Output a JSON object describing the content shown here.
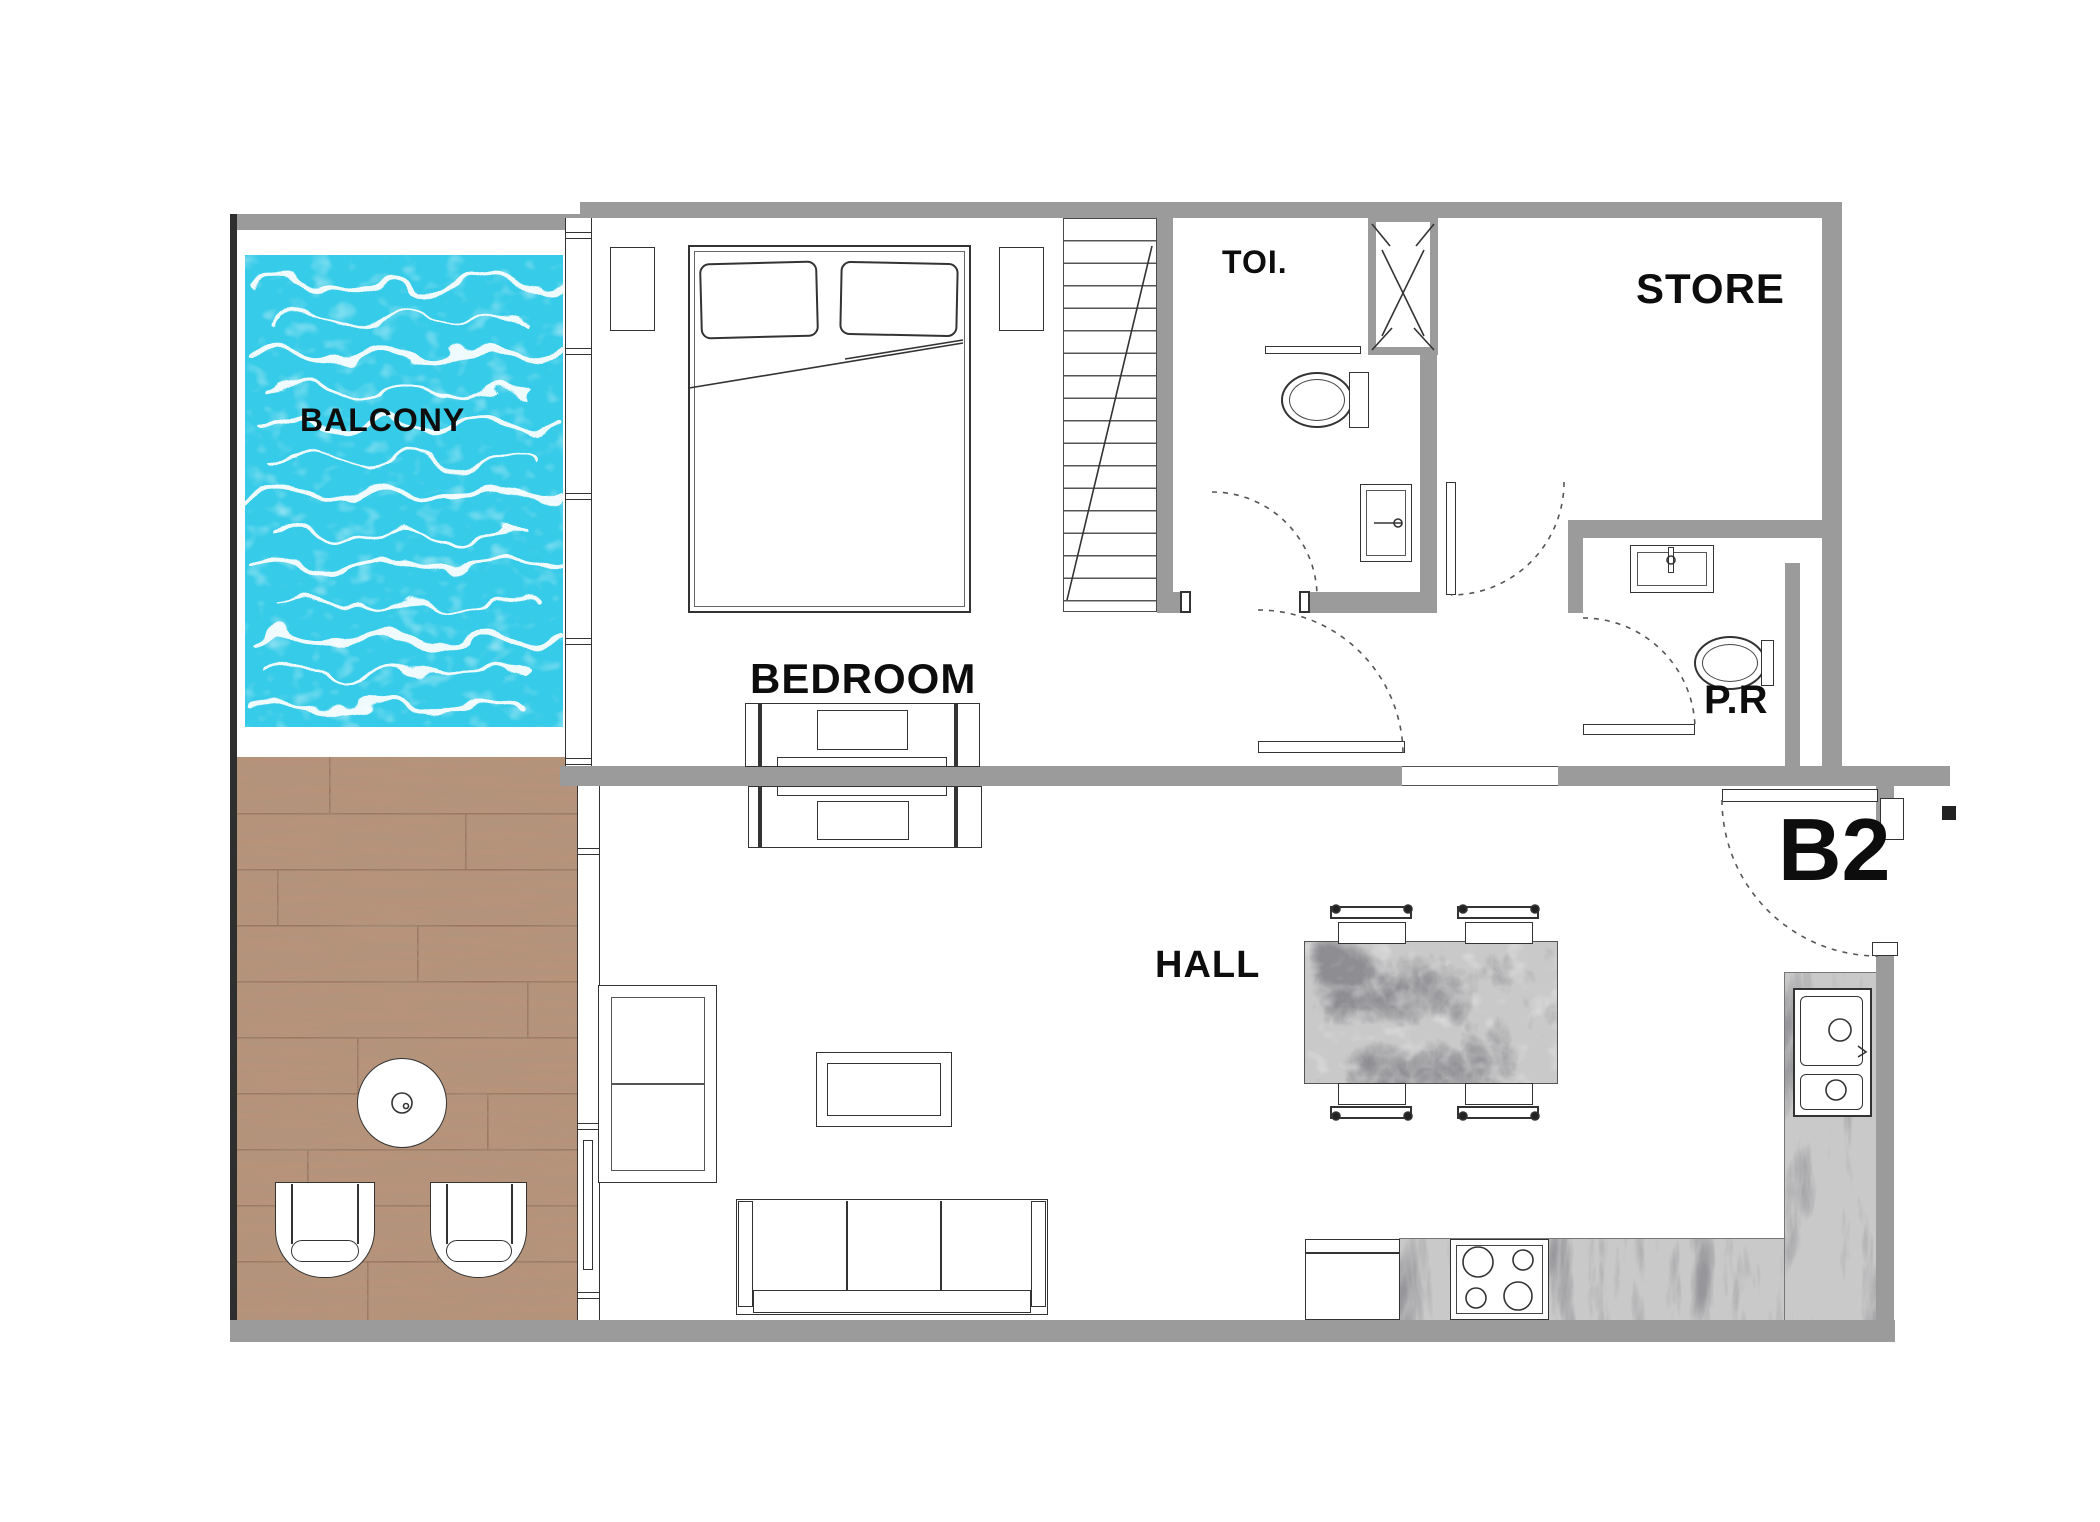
{
  "unit": {
    "label": "B2"
  },
  "rooms": {
    "balcony": {
      "label": "BALCONY"
    },
    "bedroom": {
      "label": "BEDROOM"
    },
    "toilet": {
      "label": "TOI."
    },
    "store": {
      "label": "STORE"
    },
    "powder_room": {
      "label": "P.R"
    },
    "hall": {
      "label": "HALL"
    }
  },
  "fixtures": {
    "balcony": [
      "plunge-pool"
    ],
    "deck": [
      "round-table",
      "deck-chair-left",
      "deck-chair-right"
    ],
    "bedroom": [
      "double-bed",
      "pillow-left",
      "pillow-right",
      "nightstand-left",
      "nightstand-right",
      "tv-console"
    ],
    "stairwell": [
      "staircase"
    ],
    "toilet": [
      "wc",
      "washbasin-cabinet",
      "duct-shaft"
    ],
    "powder_room": [
      "washbasin",
      "wc"
    ],
    "hall": [
      "armchair",
      "coffee-table",
      "sofa",
      "tv-console",
      "dining-table",
      "dining-chairs-4"
    ],
    "kitchen": [
      "dishwasher",
      "cooktop-4-burner",
      "double-bowl-sink",
      "l-shaped-marble-counter"
    ],
    "doors": [
      "toilet-door",
      "lobby-door",
      "powder-room-door",
      "corridor-door",
      "entrance-door"
    ]
  },
  "colors": {
    "wall_gray": "#9b9b9b",
    "outline": "#2f2f2f",
    "pool_water": "#36cbe8",
    "deck_wood": "#b7937a",
    "marble_base": "#c9c9c9",
    "background": "#ffffff"
  }
}
